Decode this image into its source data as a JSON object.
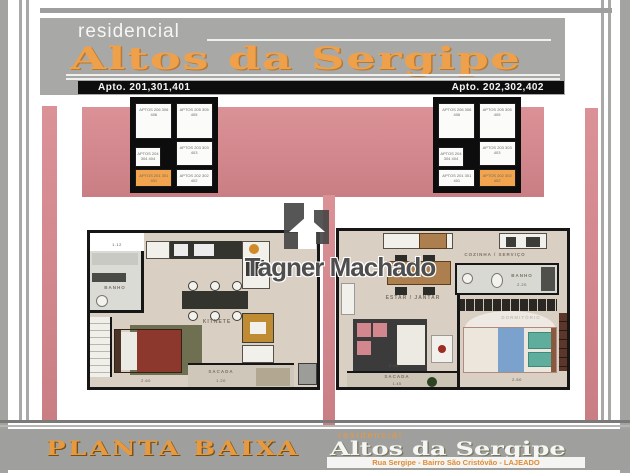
{
  "header": {
    "brand_small": "residencial",
    "brand_name": "Altos da Sergipe",
    "apto_left": "Apto. 201,301,401",
    "apto_right": "Apto. 202,302,402"
  },
  "key_plan": {
    "cells": {
      "top_left": "APTOS 206 306 406",
      "top_right": "APTOS 205 305 405",
      "mid_left": "APTOS 204 304 404",
      "mid_right": "APTOS 203 303 403",
      "bottom_left": "APTOS 201 301 401",
      "bottom_right": "APTOS 202 302 402"
    },
    "highlight_color": "#f2a54e"
  },
  "plan_left": {
    "banho": "BANHO",
    "kitnete": "KITNETE",
    "sacada": "SACADA",
    "dim_bath": "1.12",
    "dim_bed": "2.60",
    "dim_sacada": "1.20"
  },
  "plan_right": {
    "cozinha": "COZINHA / SERVIÇO",
    "estar": "ESTAR / JANTAR",
    "banho": "BANHO",
    "dormitorio": "DORMITÓRIO",
    "sacada": "SACADA",
    "dim_banho": "2.20",
    "dim_dorm": "2.50",
    "dim_sacada_w": "2.00",
    "dim_sacada_d": "1.45"
  },
  "watermark": {
    "name": "Tagner Machado"
  },
  "footer": {
    "title": "PLANTA BAIXA",
    "brand_small": "residencial",
    "brand_name": "Altos da Sergipe",
    "address": "Rua Sergipe - Bairro São Cristóvão - LAJEADO"
  },
  "colors": {
    "pink": "#d4858b",
    "orange": "#efa04b",
    "frame_gray": "#a3a3a1",
    "highlight": "#f2a54e"
  }
}
